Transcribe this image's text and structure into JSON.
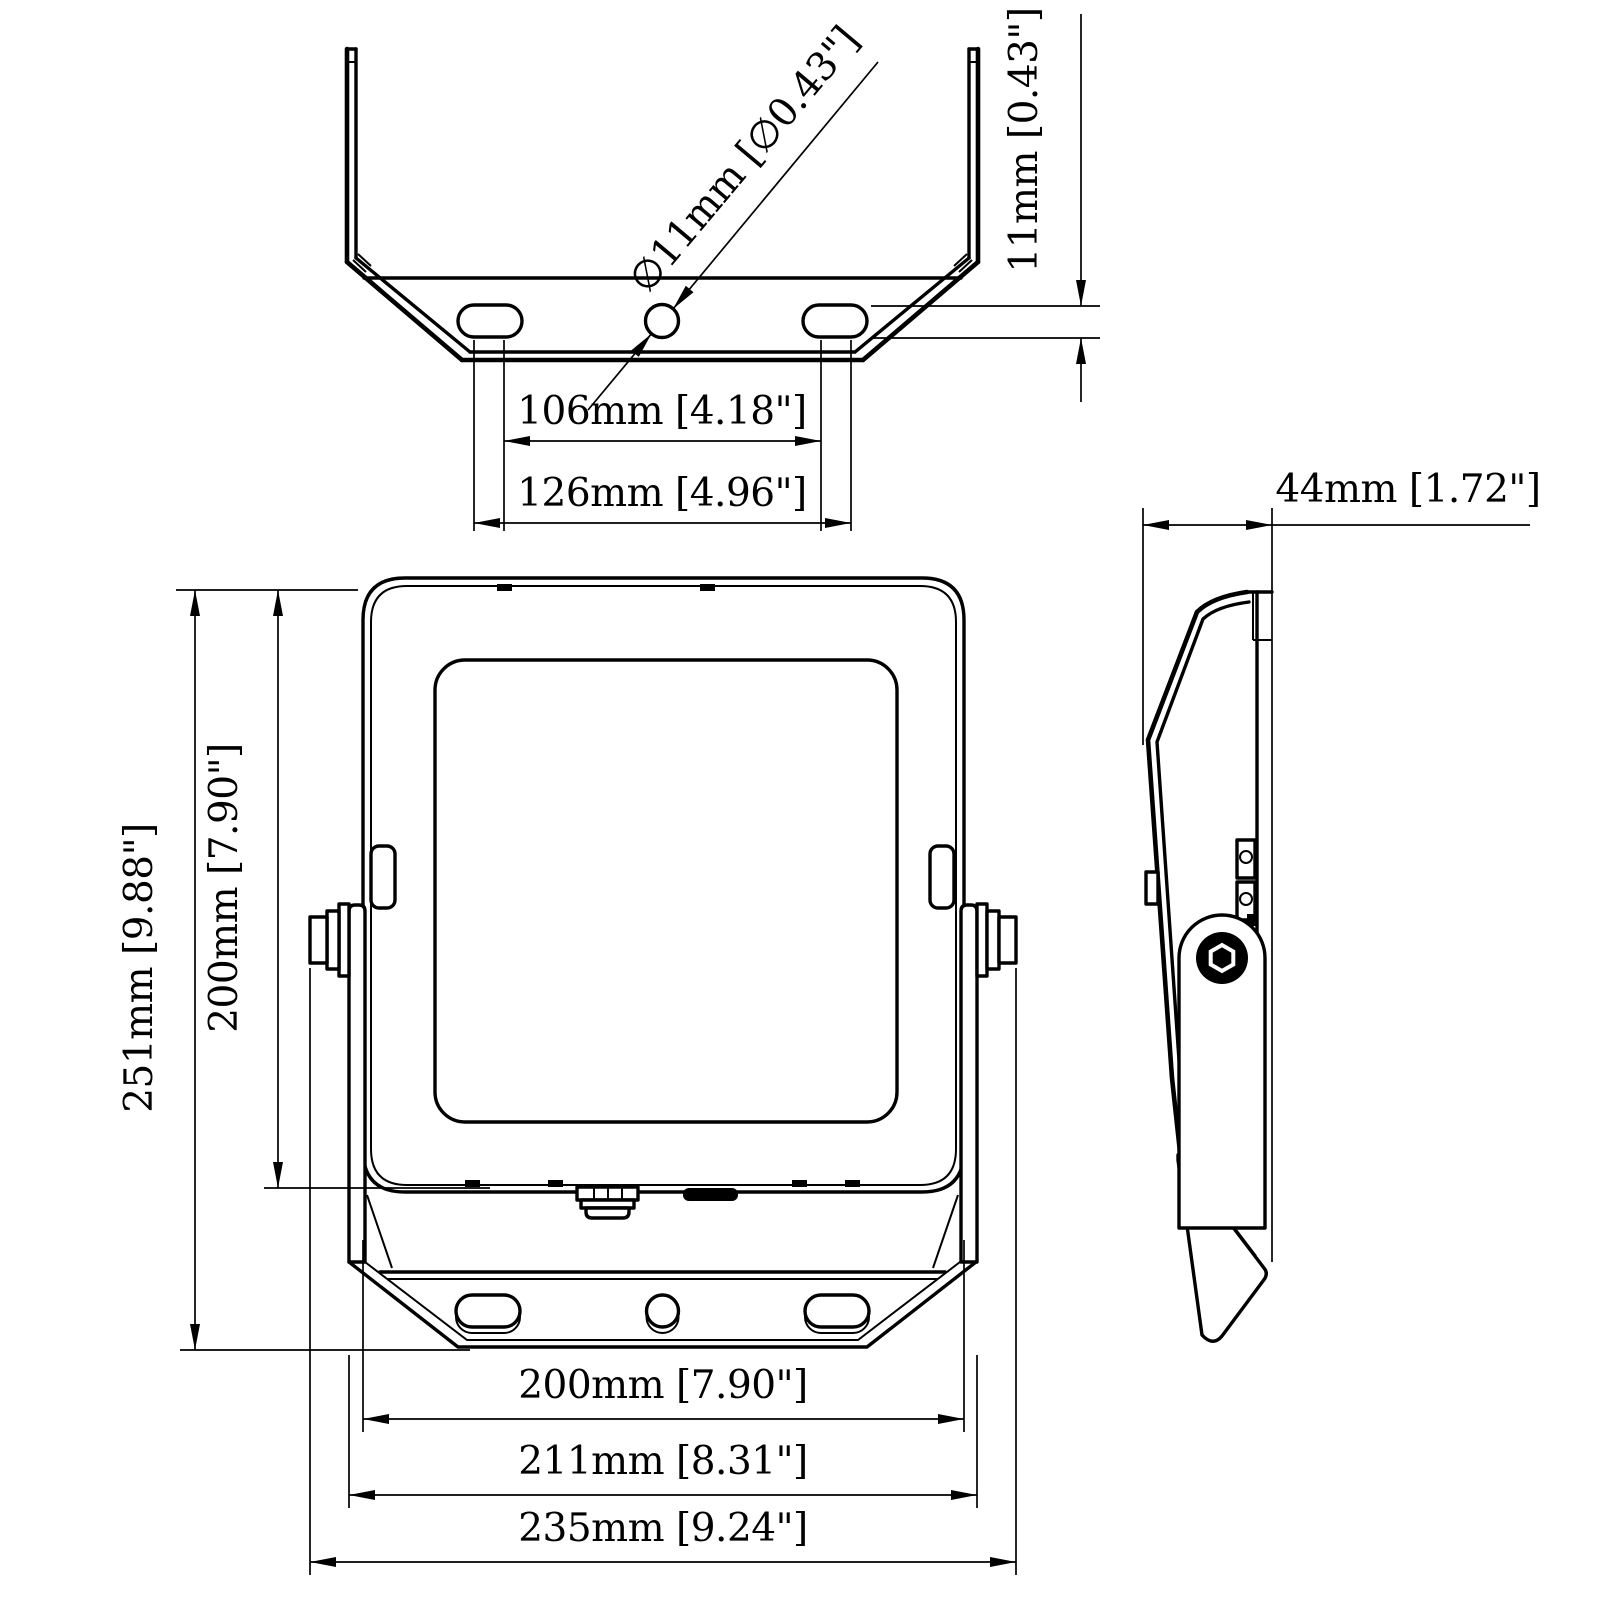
{
  "drawing": {
    "type": "technical-dimension-drawing",
    "subject": "LED floodlight with U mounting bracket, three orthographic views",
    "colors": {
      "line": "#000000",
      "background": "#ffffff"
    },
    "views": {
      "top": {
        "name": "mounting-bracket-top-view"
      },
      "front": {
        "name": "floodlight-front-view"
      },
      "side": {
        "name": "floodlight-side-view"
      }
    },
    "dimensions": {
      "hole_diameter": {
        "label": "∅11mm [∅0.43\"]",
        "mm": 11,
        "inch": 0.43
      },
      "slot_width": {
        "label": "11mm [0.43\"]",
        "mm": 11,
        "inch": 0.43
      },
      "slot_spacing_inner": {
        "label": "106mm [4.18\"]",
        "mm": 106,
        "inch": 4.18
      },
      "slot_spacing_outer": {
        "label": "126mm [4.96\"]",
        "mm": 126,
        "inch": 4.96
      },
      "depth": {
        "label": "44mm [1.72\"]",
        "mm": 44,
        "inch": 1.72
      },
      "overall_height": {
        "label": "251mm [9.88\"]",
        "mm": 251,
        "inch": 9.88
      },
      "body_height": {
        "label": "200mm [7.90\"]",
        "mm": 200,
        "inch": 7.9
      },
      "body_width": {
        "label": "200mm [7.90\"]",
        "mm": 200,
        "inch": 7.9
      },
      "bracket_width": {
        "label": "211mm [8.31\"]",
        "mm": 211,
        "inch": 8.31
      },
      "overall_width": {
        "label": "235mm [9.24\"]",
        "mm": 235,
        "inch": 9.24
      }
    }
  }
}
